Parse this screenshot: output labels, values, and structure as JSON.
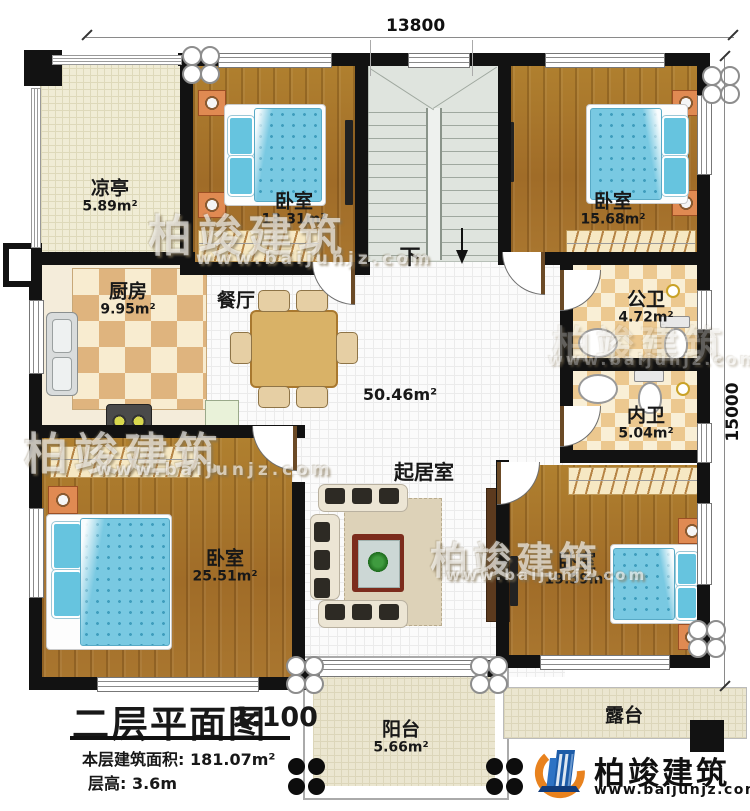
{
  "dimensions": {
    "top": "13800",
    "right": "15000"
  },
  "rooms": {
    "pavilion": {
      "name": "凉亭",
      "area": "5.89m²"
    },
    "bedroom1": {
      "name": "卧室",
      "area": "13.31m²"
    },
    "bedroom2": {
      "name": "卧室",
      "area": "15.68m²"
    },
    "kitchen": {
      "name": "厨房",
      "area": "9.95m²"
    },
    "dining": {
      "name": "餐厅"
    },
    "public_bath": {
      "name": "公卫",
      "area": "4.72m²"
    },
    "master_bath": {
      "name": "内卫",
      "area": "5.04m²"
    },
    "living": {
      "name": "起居室",
      "area": "50.46m²"
    },
    "bedroom3": {
      "name": "卧室",
      "area": "25.51m²"
    },
    "bedroom4": {
      "name": "卧室",
      "area": "19.59m²"
    },
    "balcony": {
      "name": "阳台",
      "area": "5.66m²"
    },
    "terrace": {
      "name": "露台"
    }
  },
  "stairs": {
    "down": "下"
  },
  "title_block": {
    "title": "二层平面图",
    "scale": "1:100",
    "floor_area": "本层建筑面积: 181.07m²",
    "floor_height": "层高: 3.6m"
  },
  "brand": {
    "name": "柏竣建筑",
    "website": "www.baijunjz.com"
  },
  "watermark": {
    "text": "柏竣建筑",
    "website": "www.baijunjz.com"
  },
  "colors": {
    "wall": "#121212",
    "wood": "#a9762f",
    "blanket": "#79c9e2",
    "checker": "#dfb47e",
    "brand_blue": "#1d5ca8",
    "brand_orange": "#e8821e"
  }
}
